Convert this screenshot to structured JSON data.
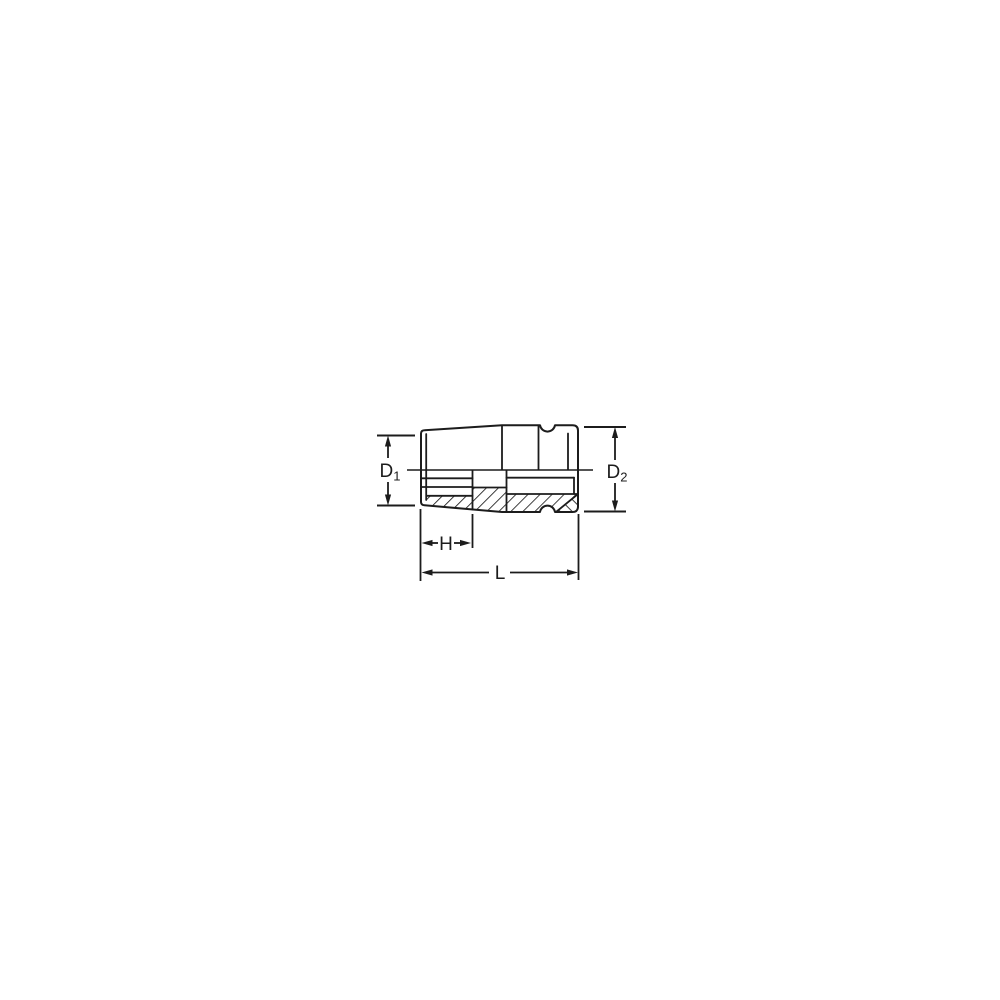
{
  "figure": {
    "background_color": "#ffffff",
    "line_color": "#1c1c1c",
    "labels": {
      "d1_base": "D",
      "d1_sub": "1",
      "d2_base": "D",
      "d2_sub": "2",
      "h": "H",
      "l": "L"
    }
  }
}
